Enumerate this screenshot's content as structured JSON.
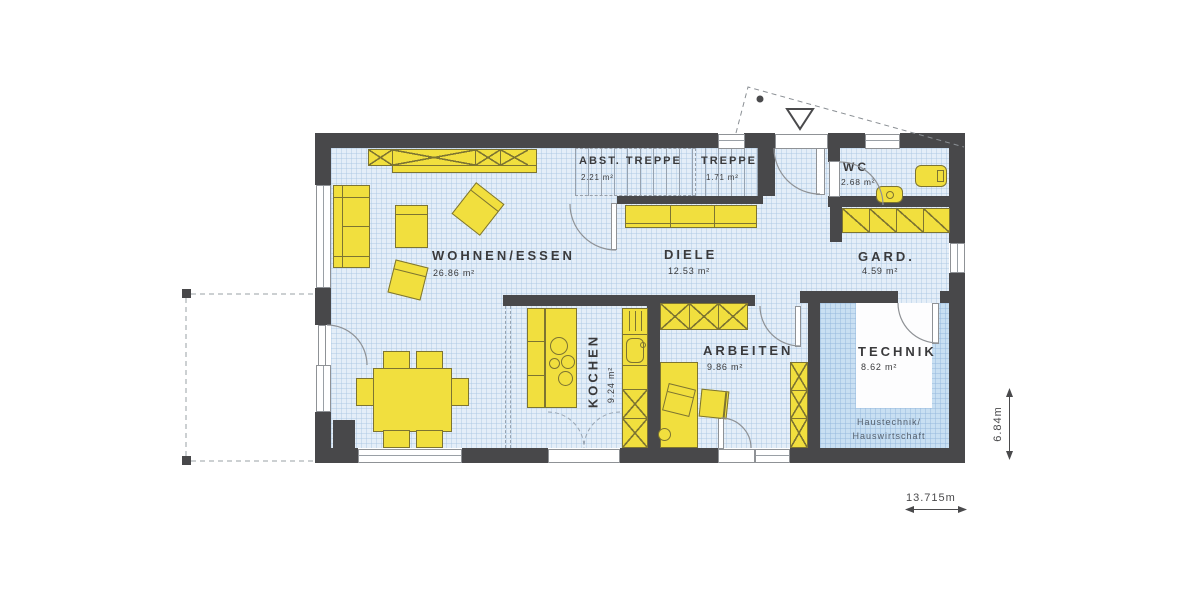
{
  "rooms": {
    "wohnen": {
      "name": "WOHNEN/ESSEN",
      "area": "26.86 m²"
    },
    "diele": {
      "name": "DIELE",
      "area": "12.53 m²"
    },
    "abst": {
      "name": "ABST. TREPPE",
      "area": "2.21 m²"
    },
    "treppe": {
      "name": "TREPPE",
      "area": "1.71 m²"
    },
    "wc": {
      "name": "WC",
      "area": "2.68 m²"
    },
    "gard": {
      "name": "GARD.",
      "area": "4.59 m²"
    },
    "kochen": {
      "name": "KOCHEN",
      "area": "9.24 m²"
    },
    "arbeiten": {
      "name": "ARBEITEN",
      "area": "9.86 m²"
    },
    "technik": {
      "name": "TECHNIK",
      "area": "8.62 m²",
      "note": [
        "Haustechnik/",
        "Hauswirtschaft"
      ]
    }
  },
  "dimensions": {
    "width": "13.715m",
    "depth": "6.84m"
  },
  "colors": {
    "wall": "#48484a",
    "floor": "#e4eef8",
    "floor_technik": "#c8dff2",
    "furniture": "#f1df3e",
    "furniture_outline": "#7d7431"
  }
}
